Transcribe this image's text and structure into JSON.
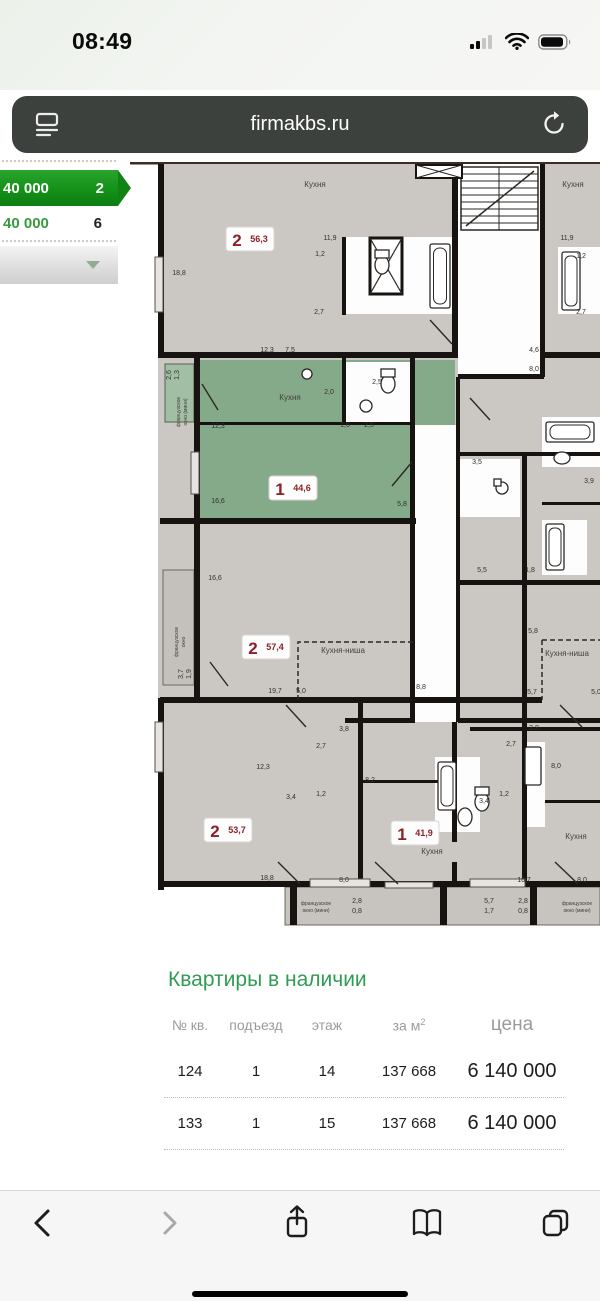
{
  "status_bar": {
    "time": "08:49"
  },
  "url_bar": {
    "url": "firmakbs.ru"
  },
  "sidebar": {
    "selected": {
      "price": "40 000",
      "count": "2"
    },
    "row2": {
      "price": "40 000",
      "count": "6"
    }
  },
  "colors": {
    "accent_green": "#2f9d52",
    "sidebar_green": "#149118",
    "plan_highlight_green": "#84aa8a",
    "plan_room_gray": "#cbc7c3",
    "badge_red": "#8e2025"
  },
  "floorplan": {
    "apartments": [
      {
        "rooms": "2",
        "area": "56,3",
        "x": 120,
        "y": 77
      },
      {
        "rooms": "1",
        "area": "44,6",
        "x": 163,
        "y": 326
      },
      {
        "rooms": "2",
        "area": "57,4",
        "x": 136,
        "y": 485
      },
      {
        "rooms": "2",
        "area": "53,7",
        "x": 98,
        "y": 668
      },
      {
        "rooms": "1",
        "area": "41,9",
        "x": 285,
        "y": 671
      }
    ],
    "room_labels": [
      {
        "t": "Кухня",
        "x": 185,
        "y": 25
      },
      {
        "t": "Кухня",
        "x": 443,
        "y": 25
      },
      {
        "t": "Кухня",
        "x": 160,
        "y": 238
      },
      {
        "t": "Кухня-ниша",
        "x": 213,
        "y": 491
      },
      {
        "t": "Кухня-ниша",
        "x": 437,
        "y": 494
      },
      {
        "t": "Кухня",
        "x": 302,
        "y": 692
      },
      {
        "t": "Кухня",
        "x": 446,
        "y": 677
      }
    ],
    "window_labels": [
      {
        "t": "французское",
        "x": 50,
        "y": 250,
        "r": -90
      },
      {
        "t": "окно (мини)",
        "x": 57,
        "y": 250,
        "r": -90
      },
      {
        "t": "французское",
        "x": 48,
        "y": 480,
        "r": -90
      },
      {
        "t": "окно",
        "x": 55,
        "y": 480,
        "r": -90
      },
      {
        "t": "французское",
        "x": 186,
        "y": 743
      },
      {
        "t": "окно (мини)",
        "x": 186,
        "y": 750
      },
      {
        "t": "французское",
        "x": 447,
        "y": 743
      },
      {
        "t": "окно (мини)",
        "x": 447,
        "y": 750
      }
    ],
    "dimensions": [
      {
        "t": "18,8",
        "x": 49,
        "y": 113
      },
      {
        "t": "12,3",
        "x": 137,
        "y": 190
      },
      {
        "t": "7,5",
        "x": 160,
        "y": 190
      },
      {
        "t": "11,9",
        "x": 200,
        "y": 78
      },
      {
        "t": "1,2",
        "x": 190,
        "y": 94
      },
      {
        "t": "2,7",
        "x": 189,
        "y": 152
      },
      {
        "t": "11,9",
        "x": 437,
        "y": 78
      },
      {
        "t": "1,2",
        "x": 451,
        "y": 96
      },
      {
        "t": "2,7",
        "x": 451,
        "y": 152
      },
      {
        "t": "4,6",
        "x": 404,
        "y": 190
      },
      {
        "t": "8,0",
        "x": 404,
        "y": 209
      },
      {
        "t": "2,6",
        "x": 41,
        "y": 213,
        "r": -90
      },
      {
        "t": "1,3",
        "x": 49,
        "y": 213,
        "r": -90
      },
      {
        "t": "2,0",
        "x": 199,
        "y": 232
      },
      {
        "t": "2,5",
        "x": 247,
        "y": 222
      },
      {
        "t": "12,3",
        "x": 88,
        "y": 266
      },
      {
        "t": "1,6",
        "x": 215,
        "y": 265
      },
      {
        "t": "2,5",
        "x": 239,
        "y": 265
      },
      {
        "t": "16,6",
        "x": 88,
        "y": 341
      },
      {
        "t": "5,8",
        "x": 272,
        "y": 344
      },
      {
        "t": "16,6",
        "x": 85,
        "y": 418
      },
      {
        "t": "3,5",
        "x": 347,
        "y": 302
      },
      {
        "t": "3,9",
        "x": 459,
        "y": 321
      },
      {
        "t": "3,7",
        "x": 53,
        "y": 512,
        "r": -90
      },
      {
        "t": "1,9",
        "x": 61,
        "y": 512,
        "r": -90
      },
      {
        "t": "19,7",
        "x": 145,
        "y": 531
      },
      {
        "t": "5,0",
        "x": 171,
        "y": 531
      },
      {
        "t": "8,8",
        "x": 291,
        "y": 527
      },
      {
        "t": "5,5",
        "x": 352,
        "y": 410
      },
      {
        "t": "1,8",
        "x": 400,
        "y": 410
      },
      {
        "t": "5,8",
        "x": 403,
        "y": 471
      },
      {
        "t": "5,7",
        "x": 402,
        "y": 532
      },
      {
        "t": "5,0",
        "x": 466,
        "y": 532
      },
      {
        "t": "3,8",
        "x": 214,
        "y": 569
      },
      {
        "t": "2,7",
        "x": 191,
        "y": 586
      },
      {
        "t": "3,8",
        "x": 404,
        "y": 568
      },
      {
        "t": "2,7",
        "x": 381,
        "y": 584
      },
      {
        "t": "12,3",
        "x": 133,
        "y": 607
      },
      {
        "t": "3,4",
        "x": 161,
        "y": 637
      },
      {
        "t": "1,2",
        "x": 191,
        "y": 634
      },
      {
        "t": "8,2",
        "x": 240,
        "y": 620
      },
      {
        "t": "3,4",
        "x": 354,
        "y": 641
      },
      {
        "t": "1,2",
        "x": 374,
        "y": 634
      },
      {
        "t": "8,0",
        "x": 426,
        "y": 606
      },
      {
        "t": "18,8",
        "x": 137,
        "y": 718
      },
      {
        "t": "8,0",
        "x": 214,
        "y": 720
      },
      {
        "t": "16,7",
        "x": 394,
        "y": 720
      },
      {
        "t": "8,0",
        "x": 452,
        "y": 720
      },
      {
        "t": "2,8",
        "x": 227,
        "y": 741
      },
      {
        "t": "0,8",
        "x": 227,
        "y": 751
      },
      {
        "t": "5,7",
        "x": 359,
        "y": 741
      },
      {
        "t": "1,7",
        "x": 359,
        "y": 751
      },
      {
        "t": "2,8",
        "x": 393,
        "y": 741
      },
      {
        "t": "0,8",
        "x": 393,
        "y": 751
      }
    ]
  },
  "table": {
    "title": "Квартиры в наличии",
    "columns": {
      "c1": "№ кв.",
      "c2": "подъезд",
      "c3": "этаж",
      "c4": "за м",
      "c4sup": "2",
      "c5": "цена"
    },
    "rows": [
      [
        "124",
        "1",
        "14",
        "137 668",
        "6 140 000"
      ],
      [
        "133",
        "1",
        "15",
        "137 668",
        "6 140 000"
      ]
    ]
  }
}
